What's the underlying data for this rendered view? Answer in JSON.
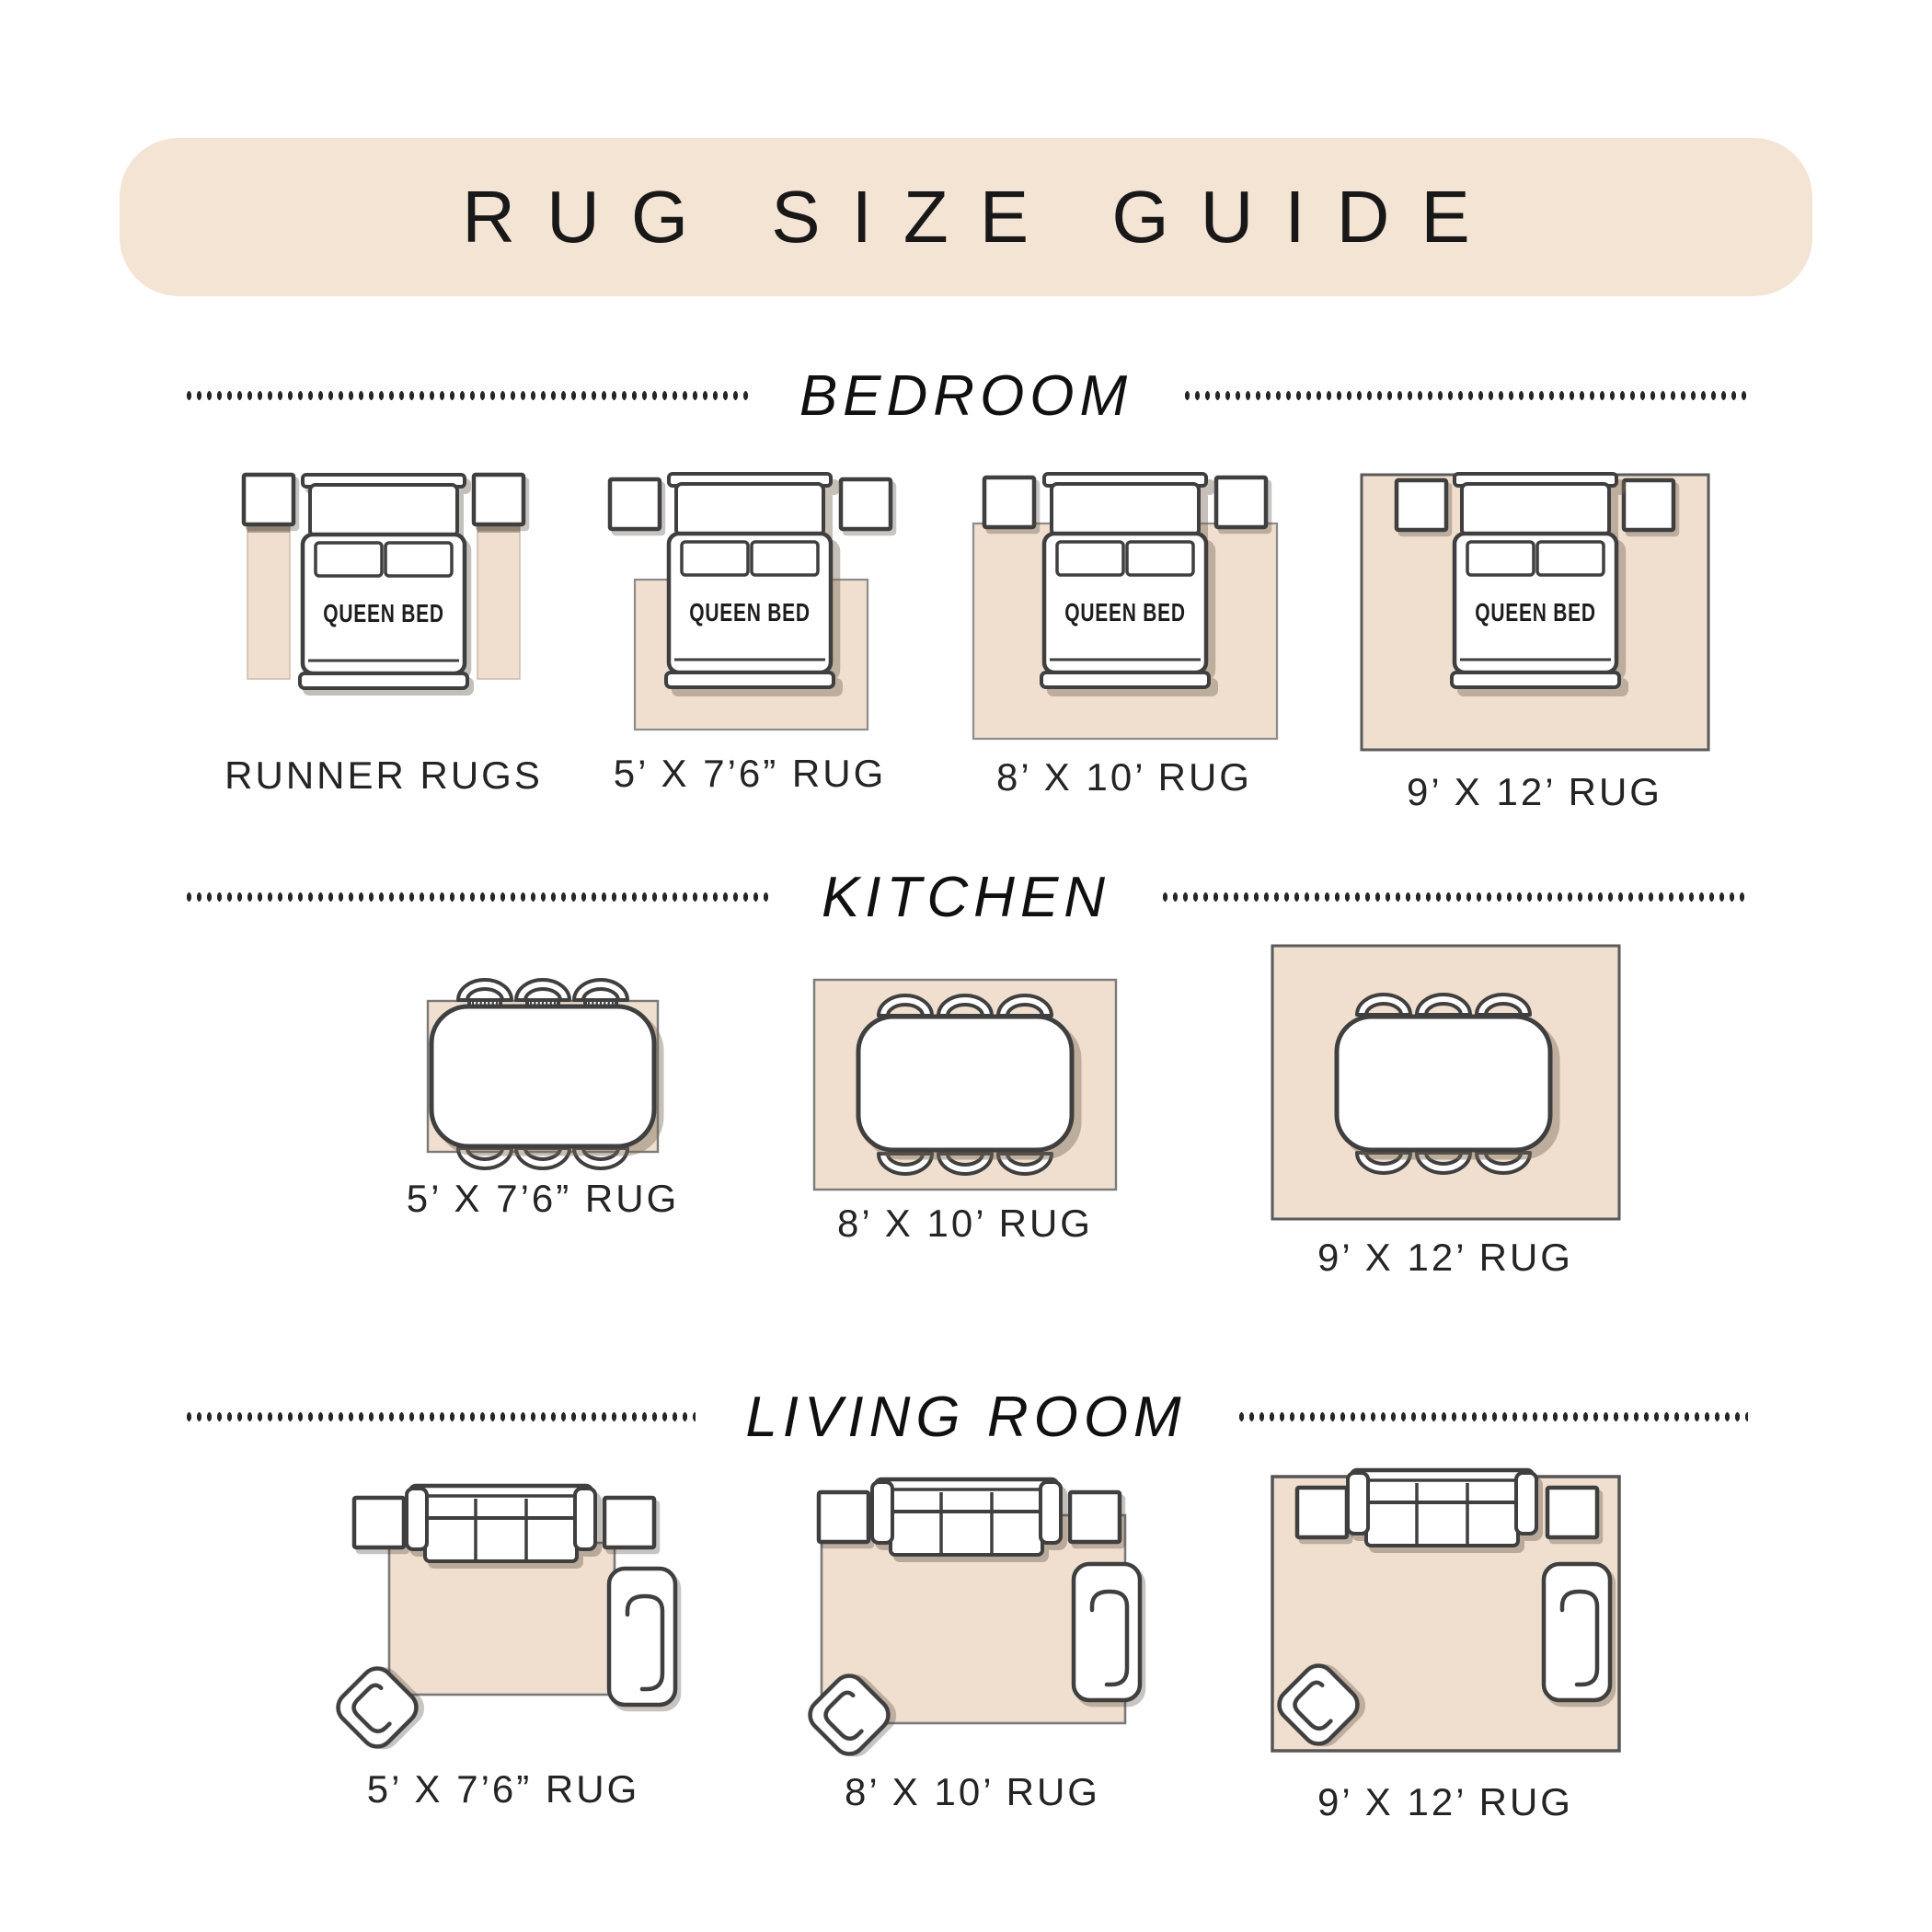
{
  "page_title": "RUG SIZE GUIDE",
  "bed_label": "QUEEN BED",
  "sections": [
    {
      "name": "BEDROOM",
      "items": [
        {
          "label": "RUNNER RUGS"
        },
        {
          "label": "5’ X 7’6” RUG"
        },
        {
          "label": "8’ X 10’ RUG"
        },
        {
          "label": "9’ X 12’ RUG"
        }
      ]
    },
    {
      "name": "KITCHEN",
      "items": [
        {
          "label": "5’ X 7’6” RUG"
        },
        {
          "label": "8’ X 10’ RUG"
        },
        {
          "label": "9’ X 12’ RUG"
        }
      ]
    },
    {
      "name": "LIVING ROOM",
      "items": [
        {
          "label": "5’ X 7’6” RUG"
        },
        {
          "label": "8’ X 10’ RUG"
        },
        {
          "label": "9’ X 12’ RUG"
        }
      ]
    }
  ],
  "colors": {
    "banner_background": "#f4e4d4",
    "rug_fill": "#f0dfce",
    "outline": "#3f3f3f",
    "text": "#242424"
  }
}
